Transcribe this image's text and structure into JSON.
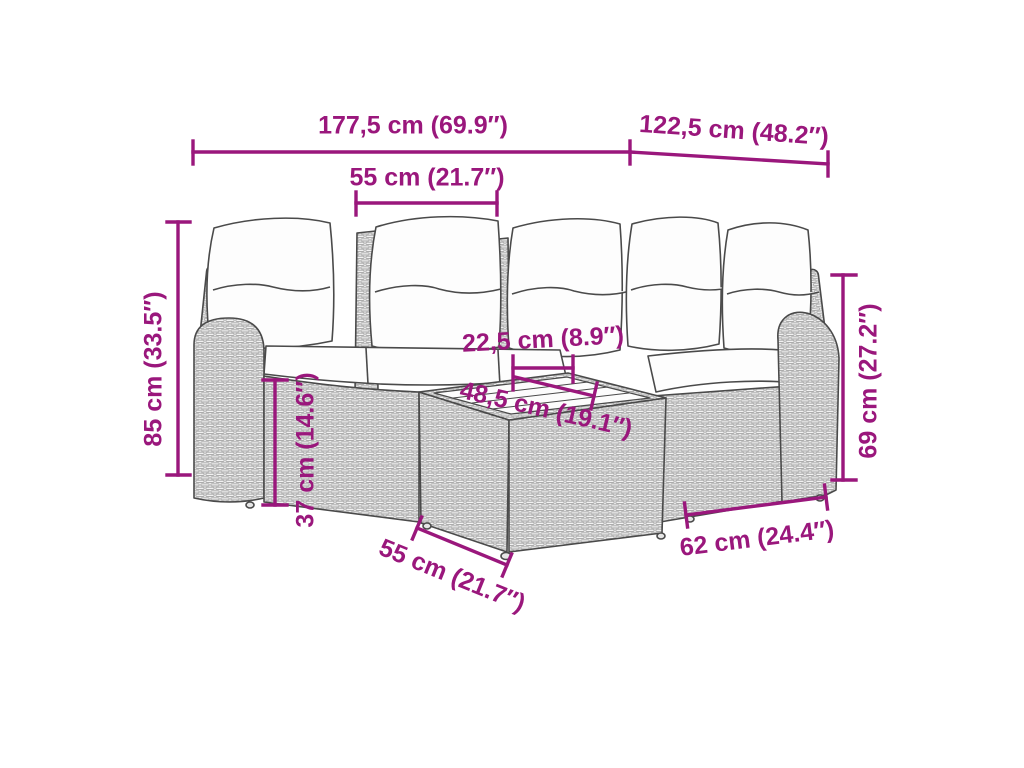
{
  "meta": {
    "subject": "Dimension diagram of a 5-piece poly rattan corner garden sofa set with cushions and coffee table"
  },
  "colors": {
    "dimension_color": "#9A177C",
    "outline_color": "#4A4A4A",
    "wicker_fill": "#F1F1F1",
    "cushion_fill": "#FDFDFD",
    "background": "#FFFFFF"
  },
  "dimensions": {
    "total_width": "177,5 cm (69.9″)",
    "right_depth": "122,5 cm (48.2″)",
    "seat_width": "55 cm (21.7″)",
    "total_height": "85 cm (33.5″)",
    "seat_height": "37 cm (14.6″)",
    "armrest_top_width": "22,5 cm (8.9″)",
    "tabletop_width": "48,5 cm (19.1″)",
    "backrest_height": "69 cm (27.2″)",
    "right_module_width": "62 cm (24.4″)",
    "table_side_width": "55 cm (21.7″)"
  }
}
